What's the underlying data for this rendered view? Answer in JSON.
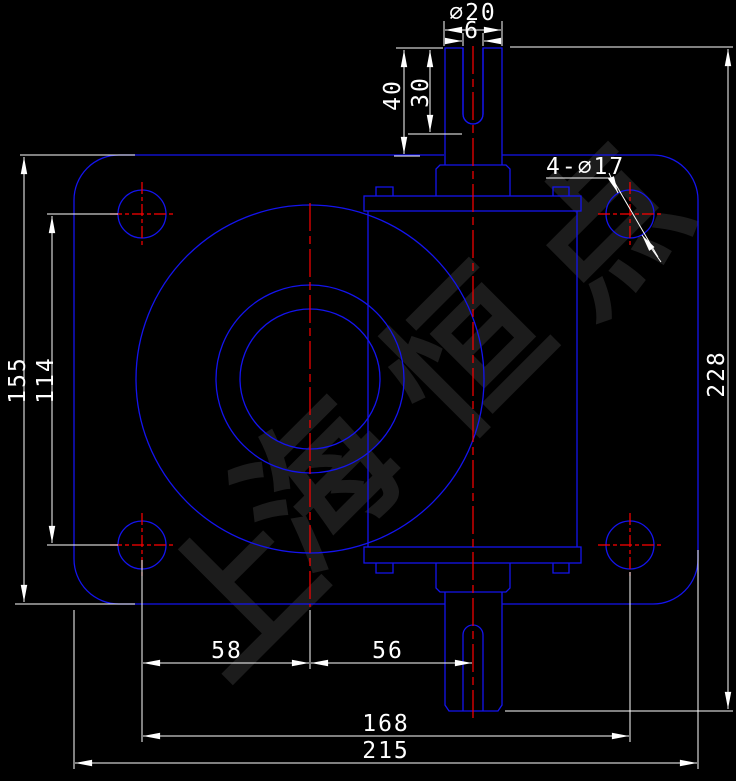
{
  "drawing": {
    "kind": "engineering-drawing-front-view",
    "colors": {
      "background": "#000000",
      "part_outline": "#1414ee",
      "centerline": "#ff0000",
      "dimension": "#ffffff",
      "watermark": "#1c1c1c"
    },
    "dimensions": {
      "shaft_diameter": "⌀20",
      "keyway_width": "6",
      "shaft_length": "40",
      "keyway_depth": "30",
      "corner_holes": "4-⌀17",
      "flange_height": "155",
      "hole_spacing_vertical": "114",
      "overall_height": "228",
      "center_offset_left": "58",
      "center_offset_right": "56",
      "hole_spacing_horizontal": "168",
      "flange_width": "215"
    },
    "watermark": {
      "char1": "上",
      "char2": "海",
      "char3": "恒",
      "char4": "点"
    }
  }
}
